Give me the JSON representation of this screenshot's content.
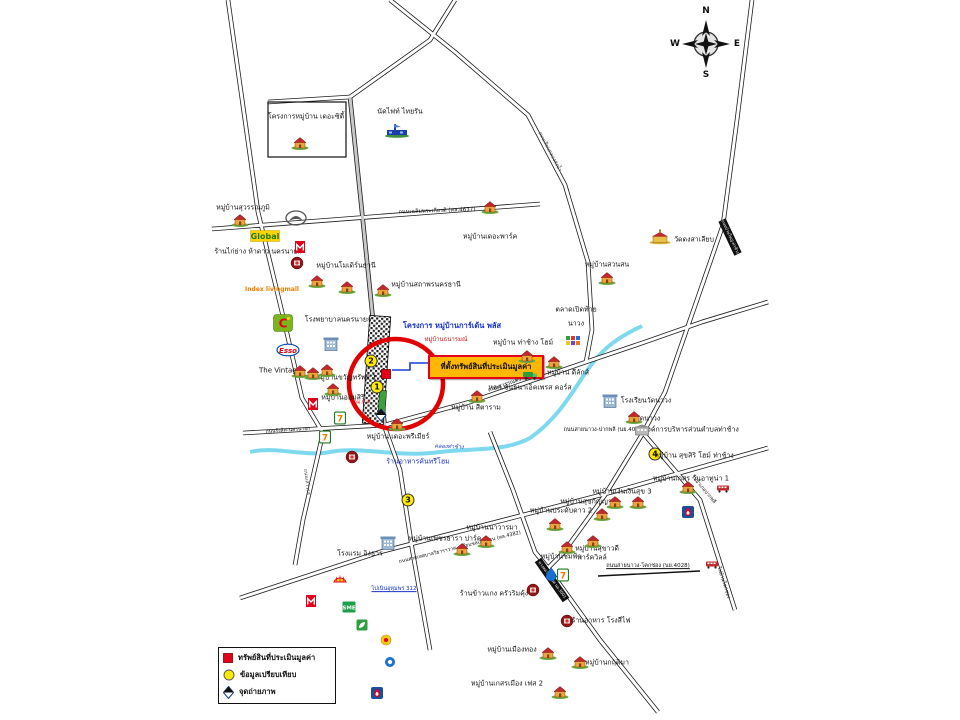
{
  "compass": {
    "n": "N",
    "e": "E",
    "s": "S",
    "w": "W"
  },
  "legend": {
    "property": "ทรัพย์สินที่ประเมินมูลค่า",
    "comparable": "ข้อมูลเปรียบเทียบ",
    "photo": "จุดถ่ายภาพ"
  },
  "comparables": [
    "1",
    "2",
    "3",
    "4"
  ],
  "highlight": {
    "property_location_label": "ที่ตั้งทรัพย์สินที่ประเมินมูลค่า",
    "project_name": "โครงการ หมู่บ้านการ์เด้น พลัส",
    "project_subname": "หมู่บ้านธนารมณ์",
    "km_marker": "กม.ที่ 4"
  },
  "roads": {
    "chalermprakiat": "ถนนเฉลิมพระเกียรติ (ทล.4637)",
    "suwannasorn": "ถนนสุวรรณศร",
    "rangsit": "ถนนรังสิต-นครนายก",
    "nawong_pakphli": "ถนนสายนาวง-ปากพลี (นย.4026)",
    "thesaban": "ถนนสายเทศบาลวิธาราวาส - เลียบชลประทาน (ทล.4382)",
    "nawong_khokchong": "ถนนสายนาวง-โคกช่อง (นย.4028)",
    "to_pakphli": "ไปอำเภอปากพลี",
    "to_khokchong": "ไปบ้านโคกช่อง",
    "saowarot": "ถนนเสาวรส",
    "khlong_song_nam": "ถนนเลียบคลองส่งน้ำ",
    "banyai_thachang": "ถนนบ้านใหญ่-ท่าช้าง",
    "rural": "ทางหลวงชนบท นย.3001",
    "to_noen": "ไปเนินอุทุมพร 312",
    "khlong_thachang": "คลองท่าช้าง"
  },
  "places": {
    "the_city": "โครงการหมู่บ้าน เดอะซิตี้",
    "nadfight": "นัดไฟท์ ไทยรัน",
    "the_park": "หมู่บ้านเดอะพาร์ค",
    "suwannaphum": "หมู่บ้านสุวรรณภูมิ",
    "kaiyang": "ร้านไก่ย่าง ห้าดาว นครนายก",
    "modern_thani": "หมู่บ้านโมเดิร์นธานี",
    "sathaporn": "หมู่บ้านสถาพรนครธานี",
    "hospital": "โรงพยาบาลนครนายก",
    "vintage": "The Vintage",
    "khwansap": "หมู่บ้านขวัญทรัพย์ 1",
    "aomsiri": "หมู่บ้านออมสิริ",
    "sitaram": "หมู่บ้าน สีตาราม",
    "premier": "หมู่บ้าน เดอะพรีเมียร์",
    "country_home": "ร้านอาหารคันทรีโฮม",
    "talat_line1": "ตลาดเปิดท้าย",
    "talat_line2": "นาวง",
    "thachang_home": "หมู่บ้าน ท่าช้าง โฮม์",
    "deluxe": "หมู่บ้าน ดีลักส์",
    "chanthana": "หจก.ชันธนาเอ็คเพรส คอร์ส",
    "wat_dong": "วัดดงสาเลียบ",
    "suan_son": "หมู่บ้านสวนสน",
    "school_nawong": "โรงเรียนวัดนาวง",
    "wat_nawong": "วัดนาวง",
    "abt_thachang": "องค์การบริหารส่วนตำบลท่าช้าง",
    "suksiri": "หมู่บ้าน สุขสิริ โฮม์ ท่าช้าง",
    "kesorn": "หมู่บ้านเกสร วันอาทูน่า 1",
    "ngoenngoen": "หมู่บ้านเงินเงินสุข 3",
    "phettara": "หมู่บ้านเพชรธารา ปาร์ค",
    "navarama": "หมู่บ้านนาวารมา",
    "pradabdao": "หมู่บ้านประดับดาว 2",
    "sukkanya": "หมู่บ้านสุขกัญญา",
    "chomfah": "หมู่บ้านชมฟ้า",
    "sukhavadee": "หมู่บ้านสุขาวดี",
    "parkville": "พาร์ควิลล์",
    "hotel": "โรงแรม อิงธาร",
    "khaokang": "ร้านข้าวแกง ครัวริมคุ้ง",
    "rongsifai": "ร้านอาหาร โรงสีไฟ",
    "krittima": "หมู่บ้านกฤติมา",
    "muangthong": "หมู่บ้านเมืองทอง",
    "kesorn_muang": "หมู่บ้านเกสรเมือง เฟส 2"
  },
  "logos": {
    "bigc_letter": "C",
    "esso": "Esso",
    "global": "Global",
    "seven": "7",
    "sme": "SME",
    "index_living_mall": "Index livingmall"
  }
}
